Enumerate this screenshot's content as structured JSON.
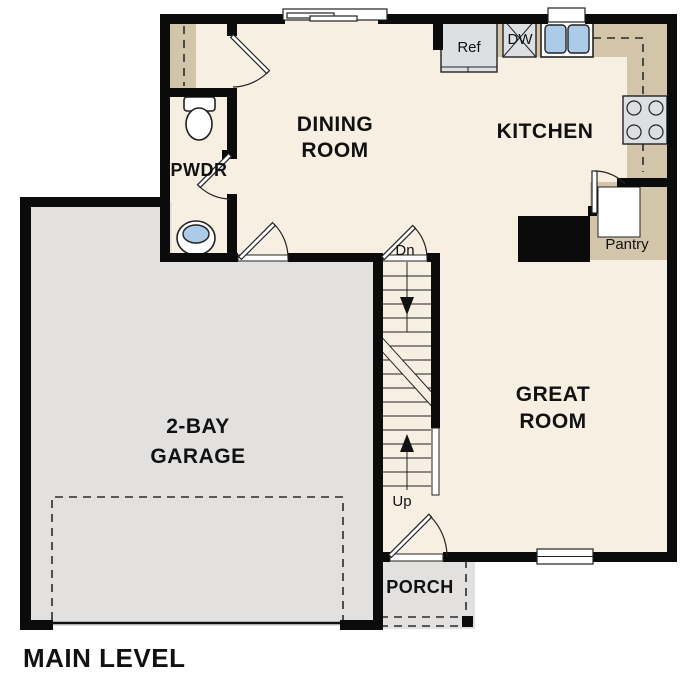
{
  "plan": {
    "title": "MAIN LEVEL",
    "rooms": {
      "dining": {
        "lines": [
          "DINING",
          "ROOM"
        ]
      },
      "kitchen": {
        "label": "KITCHEN"
      },
      "great": {
        "lines": [
          "GREAT",
          "ROOM"
        ]
      },
      "garage": {
        "lines": [
          "2-BAY",
          "GARAGE"
        ]
      },
      "pwdr": {
        "label": "PWDR"
      },
      "porch": {
        "label": "PORCH"
      },
      "pantry": {
        "label": "Pantry"
      }
    },
    "appliances": {
      "refrigerator": "Ref",
      "dishwasher": "DW"
    },
    "stairs": {
      "down": "Dn",
      "up": "Up"
    }
  },
  "colors": {
    "floor": "#f7efe2",
    "garage": "#e2e1df",
    "counter": "#d2c5aa",
    "appliance": "#dde0e3",
    "sink_blue": "#abcbe9",
    "wall": "#0b0b0b",
    "outline": "#222222",
    "text": "#111111",
    "bg": "#ffffff"
  }
}
